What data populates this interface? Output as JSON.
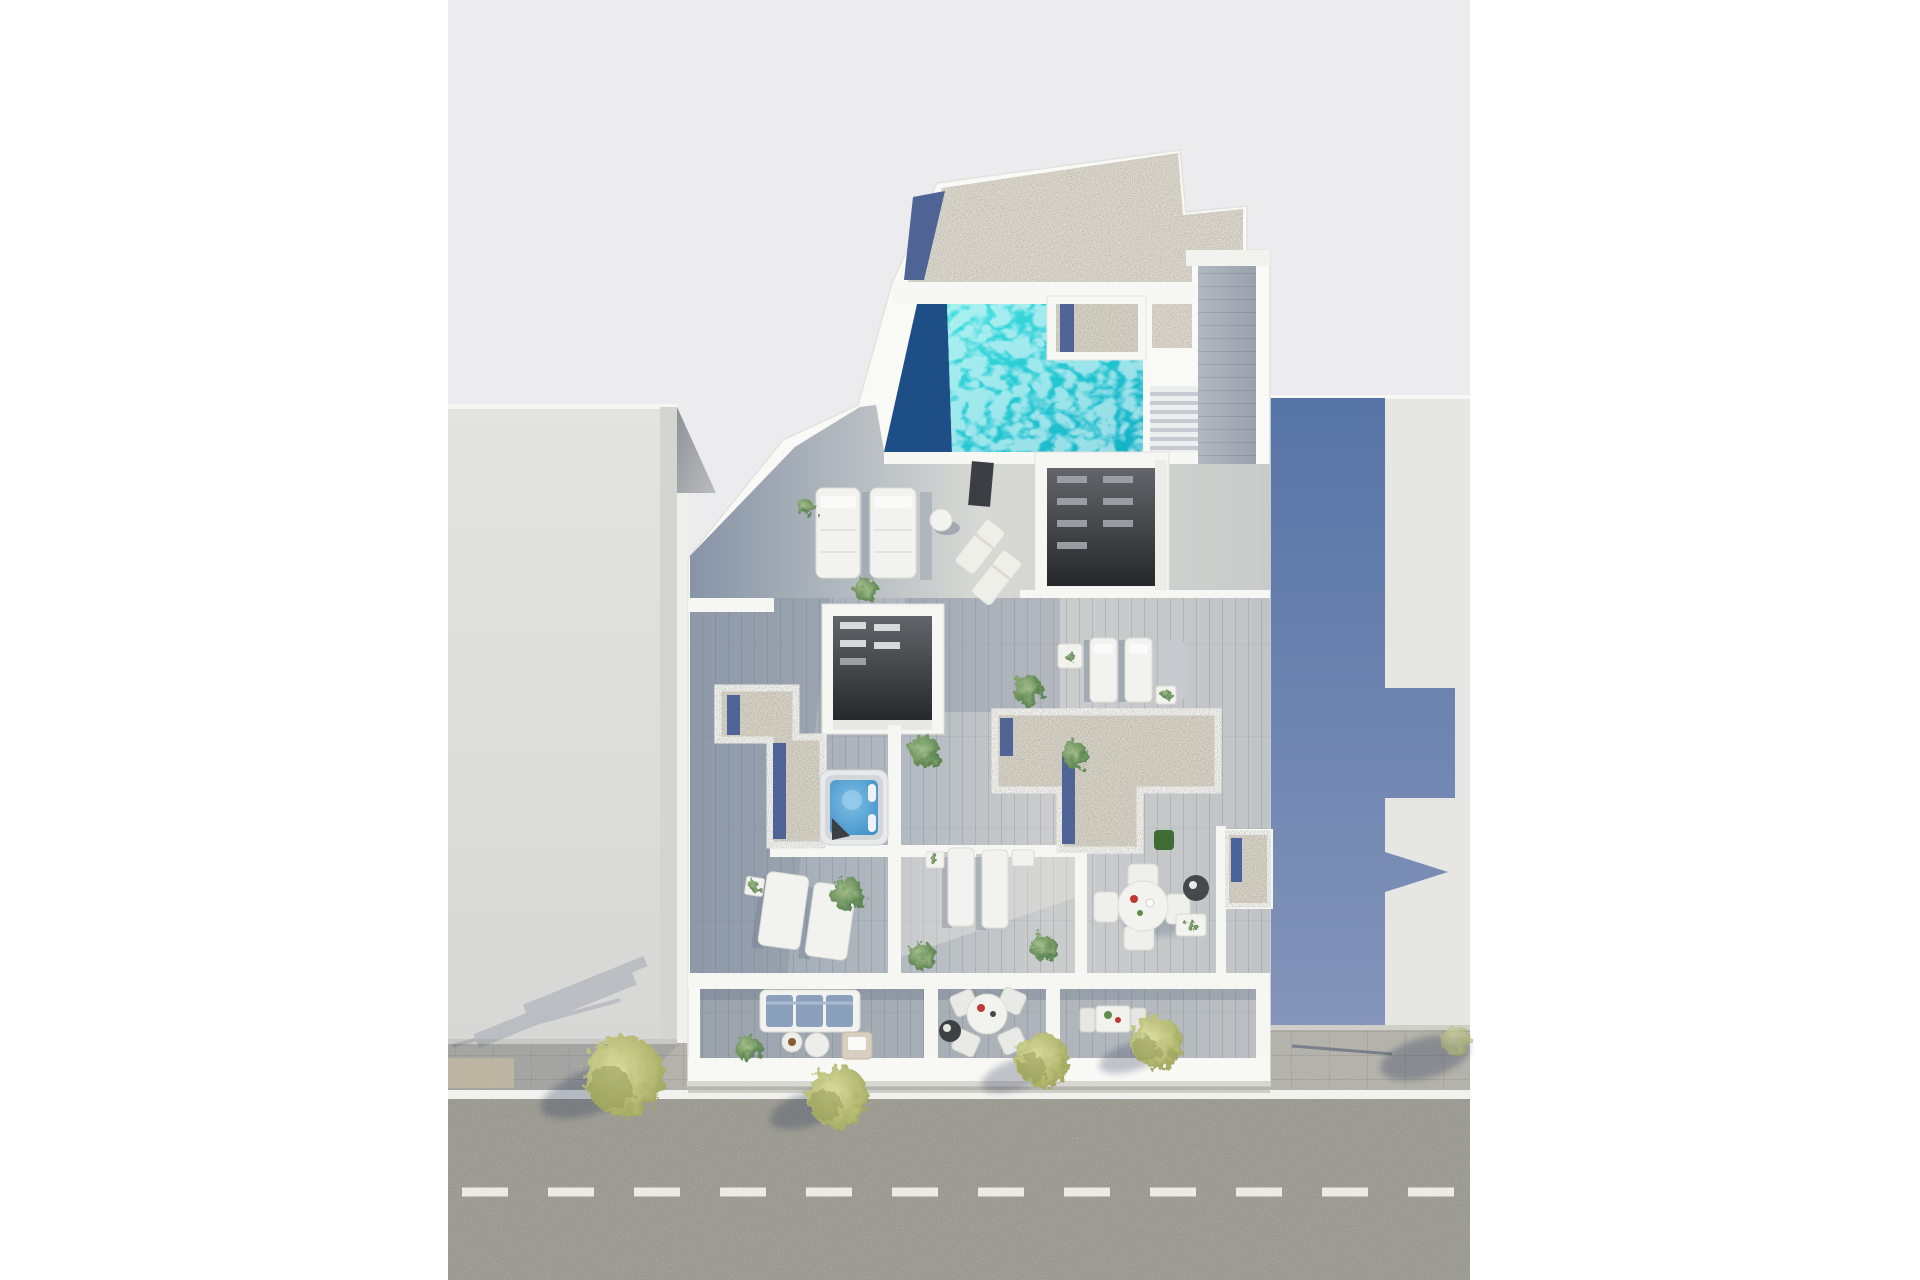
{
  "meta": {
    "title": "Aerial 3D floor-plan render",
    "scene": "Top-down architectural render of a penthouse roof level with pool, terraces, hot tub, skylights and street-front balconies"
  },
  "colors": {
    "page": "#ffffff",
    "backdrop": "#ececee",
    "road": "#9b9b92",
    "road_marking": "#edebe2",
    "curb": "#f1f1ed",
    "sidewalk": "#b8b7af",
    "paver_beige": "#d8cbae",
    "neighbor_right_roof": "#e6e6e3",
    "shadow_blue": "#5e78a8",
    "wall_white": "#f7f7f4",
    "gravel": "#dbd6ca",
    "pebble_blue": "#4a639b",
    "pool_deep": "#1d4e86",
    "pool_water": "#2fd0d8",
    "hottub_rim": "#e8e9ea",
    "skylight_dark": "#2e2f31",
    "deck_shadow": "#8793a5",
    "deck_bright": "#d8d9d5",
    "tree_green": "#aeb468",
    "plant_green": "#5b8e4a",
    "sofa_blue": "#8ba0bd",
    "accent_red": "#c03a34",
    "table_white": "#f2f2ef",
    "dark_furniture": "#3b3e42"
  },
  "objects": {
    "pool": "rooftop swimming pool with deep-end shadow",
    "hot_tub": "square jacuzzi with blue water",
    "skylights": 2,
    "sun_loungers": 9,
    "folding_deck_chairs": 2,
    "dining_sets": 3,
    "balconies": 3,
    "street_trees": 4,
    "stairs": "deck stairs beside pool",
    "gravel_roofs": 4,
    "neighbor_buildings": 2,
    "road": "asphalt street with dashed centre line"
  }
}
